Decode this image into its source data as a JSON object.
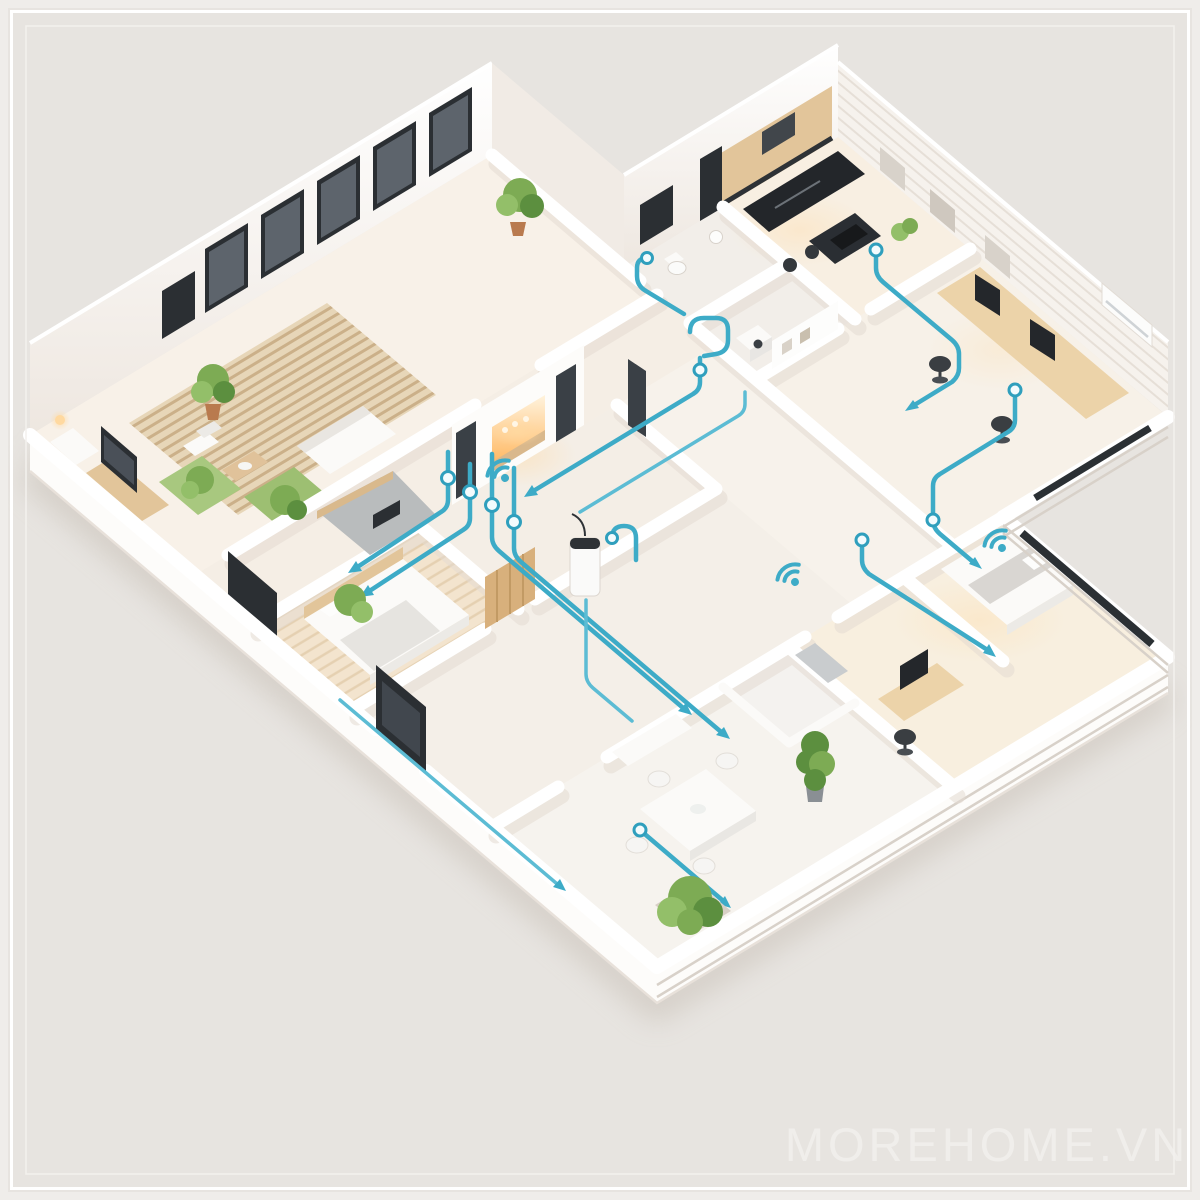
{
  "frame": {
    "background_color": "#e7e4e0",
    "border_color": "#ffffff"
  },
  "watermark": {
    "text": "MOREHOME.VN"
  },
  "palette": {
    "accent_wiring_blue": "#3dabc7",
    "junction_node_stroke": "#2f9fbd",
    "wall_white": "#fdfcfa",
    "wall_shadow": "#e3dbd2",
    "floor_cream": "#f7f2eb",
    "rug_beige": "#e6d4b6",
    "wood_tone": "#e2c59a",
    "dark_fixture": "#2b2f33",
    "plant_green": "#6fa24c",
    "warm_glow": "#ffcf8e",
    "base_shadow": "#b5aa9e"
  },
  "scene": {
    "type": "isometric-3d-apartment-cutaway",
    "overlay": {
      "wiring_lines": "smart-home cable routes along floors and walls",
      "junction_nodes": 12,
      "wifi_hotspots": 3,
      "flow_arrows": 10
    },
    "rooms": [
      {
        "name": "living-room"
      },
      {
        "name": "hallway"
      },
      {
        "name": "fireplace-lounge"
      },
      {
        "name": "bedroom-left"
      },
      {
        "name": "bathroom"
      },
      {
        "name": "bathroom-2"
      },
      {
        "name": "kitchen"
      },
      {
        "name": "home-office"
      },
      {
        "name": "bedroom-right"
      },
      {
        "name": "ensuite-bathroom"
      },
      {
        "name": "dining-area"
      },
      {
        "name": "entrance-hall"
      }
    ]
  }
}
